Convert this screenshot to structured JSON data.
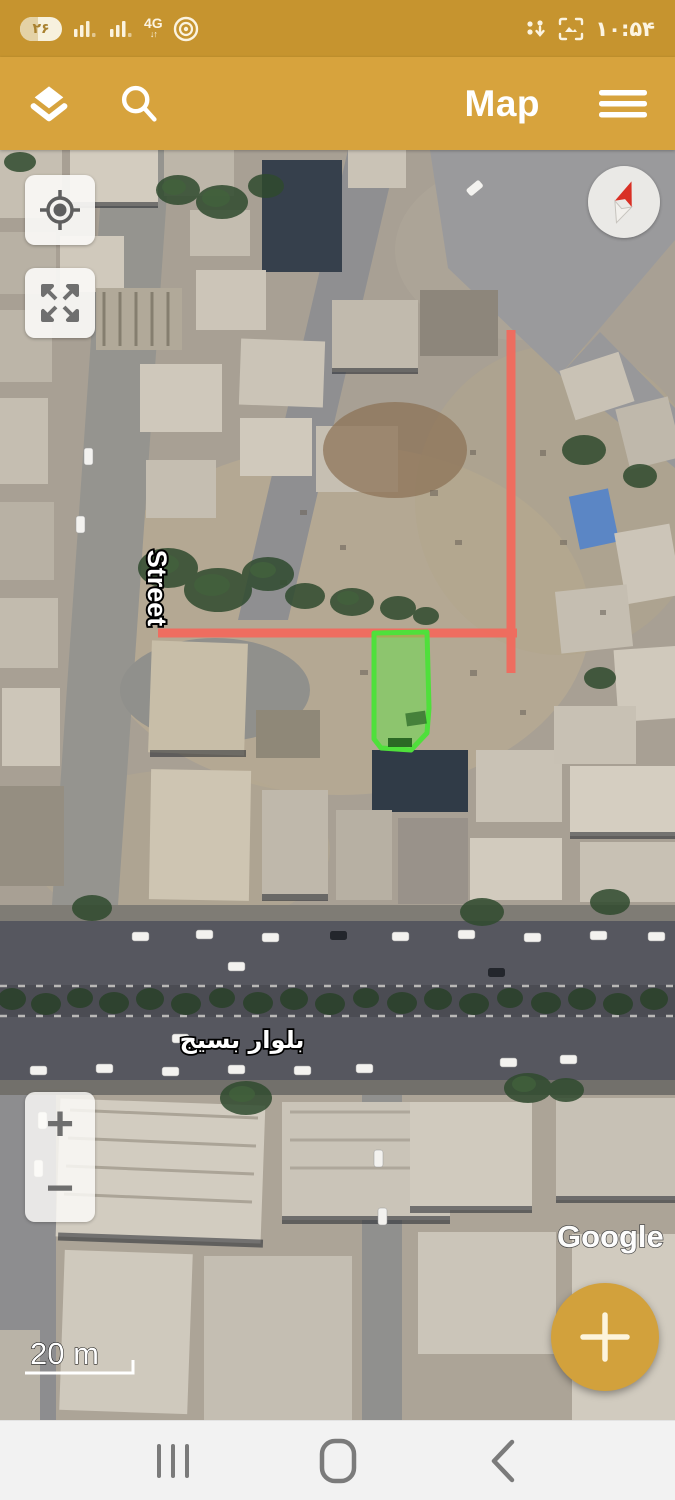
{
  "status_bar": {
    "battery_percent": "۲۶",
    "network_type": "4G",
    "network_arrows": "↓↑",
    "time": "۱۰:۵۴",
    "icons": [
      "battery-pill",
      "signal-bars-sim1-icon",
      "signal-bars-sim2-icon",
      "network-4g-icon",
      "hotspot-icon",
      "data-transfer-icon",
      "screenshot-icon"
    ]
  },
  "app_bar": {
    "title": "Map",
    "icons": [
      "layers-icon",
      "search-icon",
      "menu-icon"
    ]
  },
  "map": {
    "street_label": "Street",
    "boulevard_label": "بلوار بسیج",
    "attribution": "Google",
    "scale_label": "20 m",
    "overlays": {
      "boundary_lines": "red surveyed boundary lines",
      "parcel": "green highlighted land parcel"
    }
  },
  "controls": {
    "zoom_in_label": "+",
    "zoom_out_label": "−",
    "fab_label": "+",
    "icons": [
      "my-location-icon",
      "fullscreen-icon",
      "compass-icon",
      "add-icon"
    ]
  },
  "nav_bar": {
    "icons": [
      "recents-icon",
      "home-icon",
      "back-icon"
    ]
  },
  "colors": {
    "status_bar_gold": "#C6942F",
    "app_bar_gold": "#D7A33D",
    "fab_gold": "#D2A13C",
    "boundary_red": "#F4695C",
    "parcel_stroke_green": "#4FE03B",
    "parcel_fill_green": "#6EDC50"
  }
}
